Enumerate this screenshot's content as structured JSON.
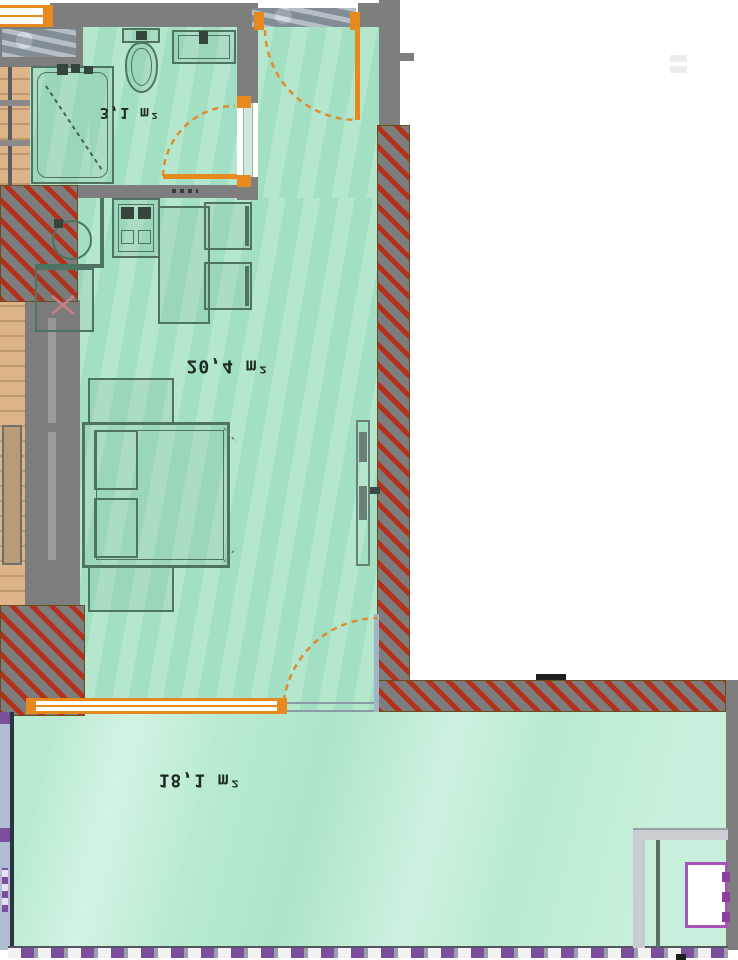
{
  "title": "apartment-floor-plan",
  "rooms": {
    "bathroom": {
      "label": "3,1 m²"
    },
    "living": {
      "label": "20,4 m²"
    },
    "terrace": {
      "label": "18,1 m²"
    }
  },
  "colors": {
    "floor": "#abe4c7",
    "terrace": "#b9ebd1",
    "wall": "#7e7e7e",
    "hatch_red": "#b5301a",
    "hatch_gray": "#7d7d7d",
    "door": "#e8891d",
    "fixture": "#4e7361",
    "wood": "#dcb488",
    "stone": "#98a3ac",
    "magenta": "#a855b8",
    "railing_purple": "#7c4f9e",
    "leaf_blue": "#9fb6c8",
    "label": "#1c2a21"
  },
  "icons": [
    "toilet-icon",
    "sink-icon",
    "shower-icon",
    "kitchen-sink-icon",
    "stove-icon",
    "appliance-x-icon",
    "table-icon",
    "chair-icon",
    "bed-icon",
    "nightstand-icon",
    "radiator-icon",
    "door-swing-icon",
    "window-icon",
    "railing-icon"
  ]
}
